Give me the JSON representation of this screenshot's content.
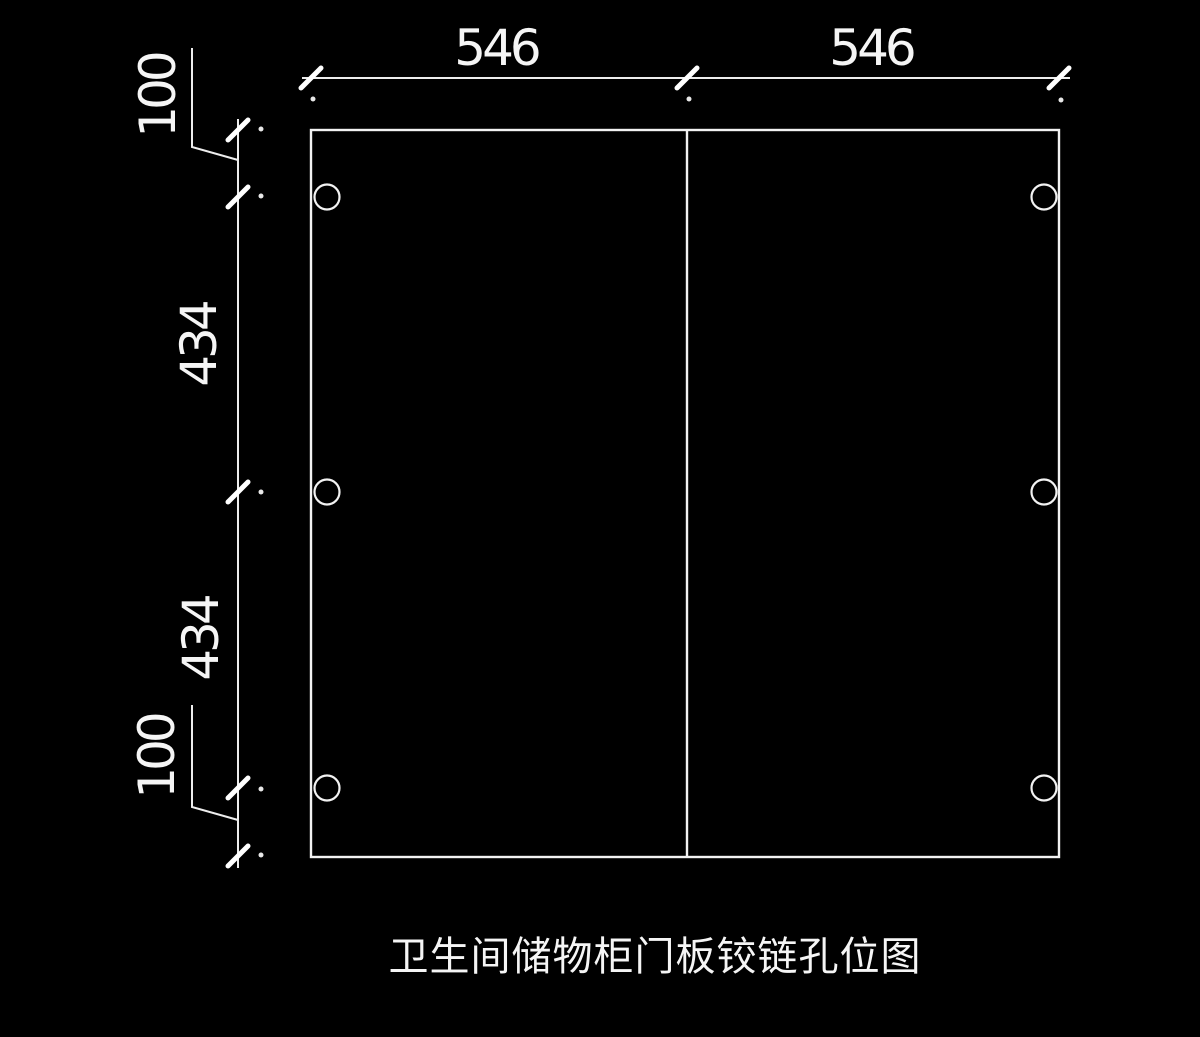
{
  "colors": {
    "background": "#000000",
    "line": "#ededed",
    "text": "#f5f5f5"
  },
  "title": "卫生间储物柜门板铰链孔位图",
  "dimensions": {
    "top": [
      "546",
      "546"
    ],
    "left": [
      "100",
      "434",
      "434",
      "100"
    ]
  }
}
